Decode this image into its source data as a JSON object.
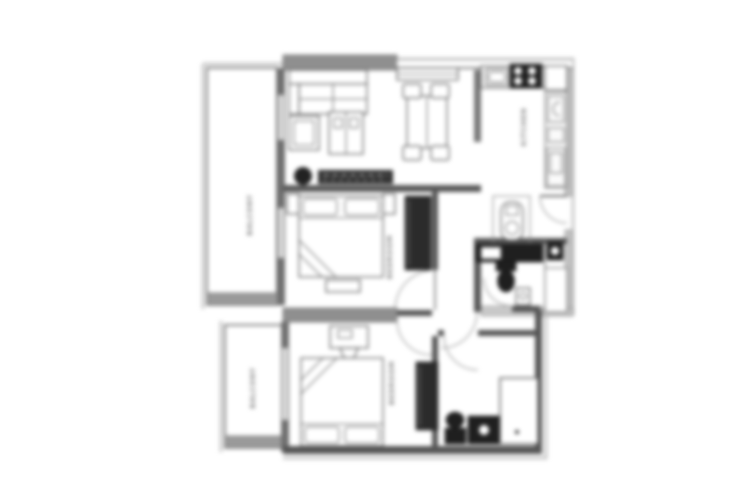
{
  "figure": {
    "kind": "apartment-floor-plan",
    "background": "#ffffff"
  },
  "floorplan": {
    "rooms": [
      {
        "id": "balcony-top",
        "label": "BALCONY"
      },
      {
        "id": "kitchen",
        "label": "KITCHEN"
      },
      {
        "id": "bedroom-middle",
        "label": "BEDROOM"
      },
      {
        "id": "bedroom-lower",
        "label": "BEDROOM"
      },
      {
        "id": "balcony-bottom",
        "label": "BALCONY"
      }
    ],
    "colors": {
      "wall_thick": "#8f8f8f",
      "wall": "#565656",
      "wall_light": "#c4c4c4",
      "rail": "#9a9a9a",
      "fixture_dark": "#1f1f1f",
      "label": "#8a8a8a"
    }
  }
}
